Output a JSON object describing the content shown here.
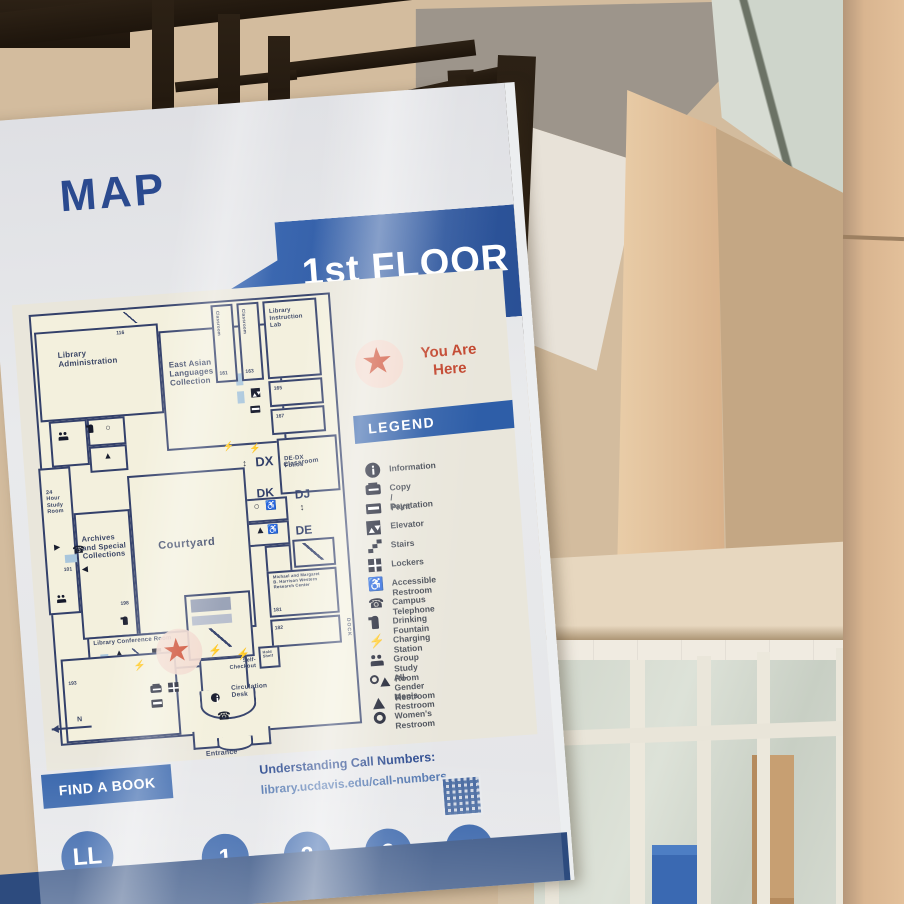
{
  "sign": {
    "title": "MAP",
    "floor_banner": "1st FLOOR",
    "you_are_here": "You Are\nHere",
    "legend": {
      "title": "LEGEND",
      "items": [
        "Information",
        "Copy / Print",
        "Paystation",
        "Elevator",
        "Stairs",
        "Lockers",
        "Accessible Restroom",
        "Campus Telephone",
        "Drinking Fountain",
        "Charging Station",
        "Group Study Room",
        "All-Gender Restroom",
        "Men's Restroom",
        "Women's Restroom"
      ]
    },
    "map": {
      "labels": {
        "library_administration": "Library\nAdministration",
        "room_116": "116",
        "east_asian_languages": "East Asian\nLanguages\nCollection",
        "classroom_vert": "Classroom",
        "room_161": "161",
        "room_163": "163",
        "library_instruction_lab": "Library\nInstruction\nLab",
        "room_165": "165",
        "room_167": "167",
        "classroom": "Classroom",
        "call_dx": "DX",
        "call_dedx_folios": "DE-DX\nFolios",
        "call_dk": "DK",
        "call_dj": "DJ",
        "call_de": "DE",
        "study_24hr": "24\nHour\nStudy\nRoom",
        "archives": "Archives\nand Special\nCollections",
        "room_198": "198",
        "courtyard": "Courtyard",
        "room_101": "101",
        "library_conference_room": "Library Conference Room",
        "harrison_center": "Michael and Margaret\nB. Harrison Western\nResearch Center",
        "room_181": "181",
        "room_182": "182",
        "room_193": "193",
        "self_checkout": "Self-\nCheckout",
        "hold_shelf": "Hold\nShelf",
        "circulation_desk": "Circulation\nDesk",
        "entrance": "Entrance",
        "dock": "DOCK",
        "north": "N"
      }
    },
    "find_a_book": "FIND A BOOK",
    "call_numbers": {
      "heading": "Understanding Call Numbers:",
      "url": "library.ucdavis.edu/call-numbers"
    },
    "floors": [
      "LL",
      "1",
      "2",
      "3",
      "4"
    ]
  },
  "icons": {
    "star": "★",
    "bolt": "⚡",
    "phone": "☎",
    "accessible": "♿",
    "arrow_right": "▶",
    "arrow_left": "◀",
    "arrow_updown": "↕",
    "triangle": "▲",
    "circle": "○",
    "info": "ℹ"
  },
  "colors": {
    "banner_blue": "#2e5ea8",
    "wall_navy": "#33406a",
    "you_are_here_red": "#c2452d",
    "room_cream": "#f3f0dd",
    "sign_background": "#e6e7ea",
    "frame_metal": "#241b12",
    "interior_beige": "#d9c2a4"
  }
}
